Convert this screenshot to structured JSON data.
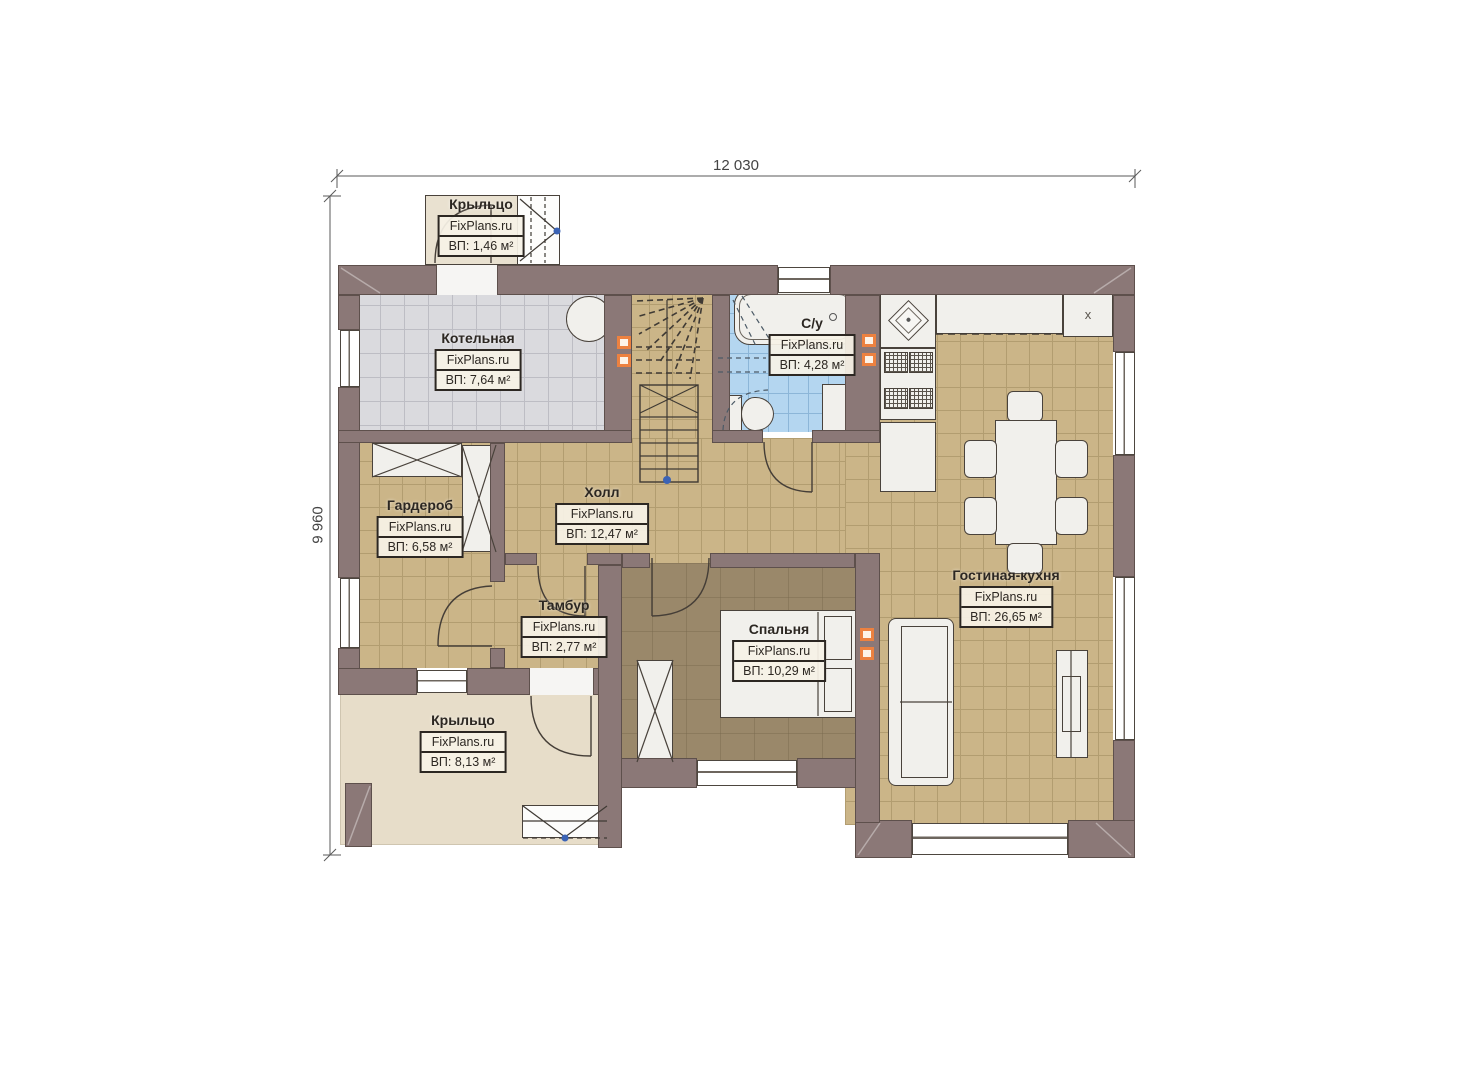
{
  "watermark": "FixPlans.ru",
  "dimensions": {
    "top": "12 030",
    "left": "9 960"
  },
  "markers": {
    "kitchen_x": "x"
  },
  "rooms": {
    "porch_top": {
      "name": "Крыльцо",
      "area": "ВП: 1,46 м²"
    },
    "boiler": {
      "name": "Котельная",
      "area": "ВП: 7,64 м²"
    },
    "bathroom": {
      "name": "С/у",
      "area": "ВП: 4,28 м²"
    },
    "wardrobe": {
      "name": "Гардероб",
      "area": "ВП: 6,58 м²"
    },
    "hall": {
      "name": "Холл",
      "area": "ВП: 12,47 м²"
    },
    "vestibule": {
      "name": "Тамбур",
      "area": "ВП: 2,77 м²"
    },
    "bedroom": {
      "name": "Спальня",
      "area": "ВП: 10,29 м²"
    },
    "living_kitchen": {
      "name": "Гостиная-кухня",
      "area": "ВП: 26,65 м²"
    },
    "porch_bottom": {
      "name": "Крыльцо",
      "area": "ВП: 8,13 м²"
    }
  },
  "colors": {
    "wall": "#8b7877",
    "floor_tan": "#cbb588",
    "floor_gray": "#dadade",
    "floor_blue": "#b4d6f0",
    "floor_beige": "#e7ddc9",
    "floor_bedroom": "#9a886a",
    "vent_orange": "#ec8140",
    "marker_blue": "#3b63b5"
  }
}
